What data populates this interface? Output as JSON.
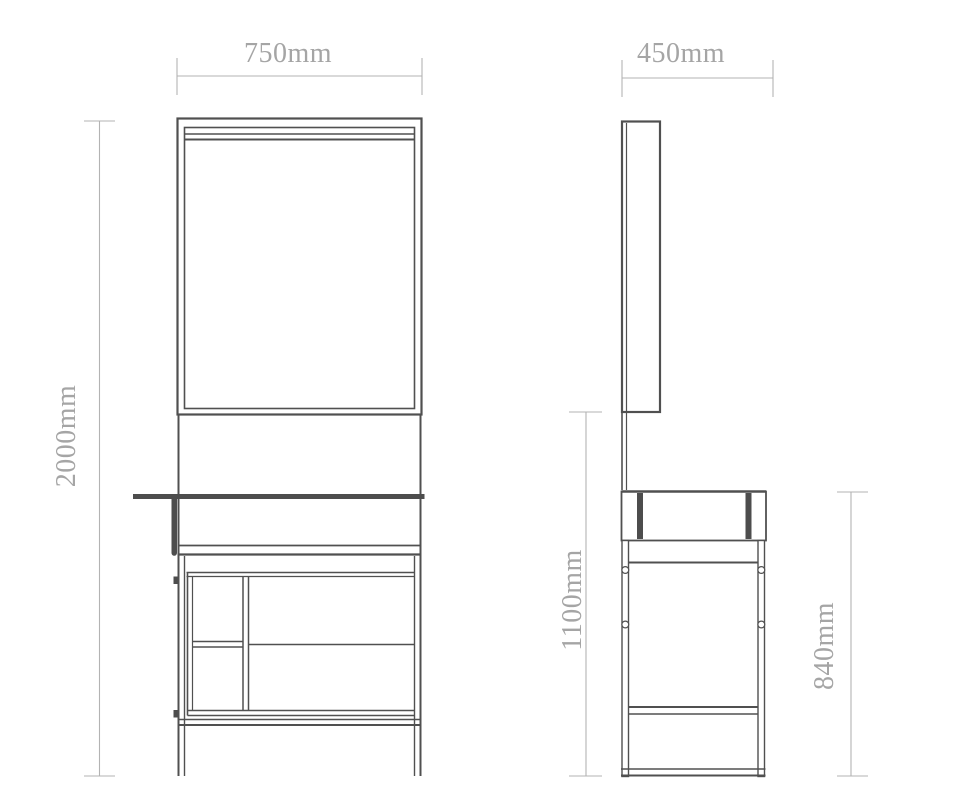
{
  "dimensions": {
    "width_label": "750mm",
    "depth_label": "450mm",
    "height_label": "2000mm",
    "mirror_height_label": "1100mm",
    "table_height_label": "840mm"
  },
  "colors": {
    "line": "#505050",
    "line_dark": "#4d4d4d",
    "dim_line": "#b3b3b3",
    "dim_text": "#a5a5a5",
    "background": "#ffffff"
  }
}
